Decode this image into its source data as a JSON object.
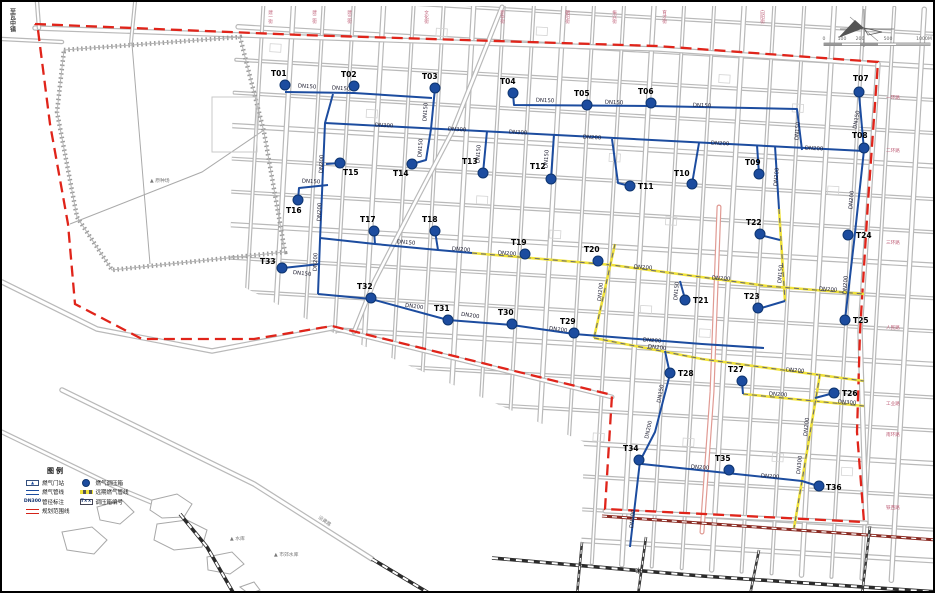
{
  "corner_text": "至瓦中镇",
  "compass": "compass-rose-icon",
  "scale_bar": {
    "labels": [
      "0",
      "100",
      "200",
      "500",
      "1000M"
    ]
  },
  "legend": {
    "title": "图例",
    "items_left": [
      {
        "swatch": "station",
        "sym_text": "▲",
        "label": "燃气门站"
      },
      {
        "swatch": "pipe",
        "sym_text": "",
        "label": "燃气管线"
      },
      {
        "swatch": "dn",
        "sym_text": "DN300",
        "label": "管径标注"
      },
      {
        "swatch": "bound",
        "sym_text": "",
        "label": "规划范围线"
      }
    ],
    "items_right": [
      {
        "swatch": "dot",
        "sym_text": "",
        "label": "燃气调压箱"
      },
      {
        "swatch": "future",
        "sym_text": "",
        "label": "远期燃气管线"
      },
      {
        "swatch": "tnum",
        "sym_text": "T××",
        "label": "调压箱编号"
      }
    ]
  },
  "colors": {
    "pipe_blue": "#1c4c9f",
    "pipe_yellow": "#f0e23a",
    "boundary_red": "#e0241a",
    "road_gray": "#b9b9b9",
    "rail_black": "#2b2b2b",
    "road_red_edge": "#e09a93"
  },
  "markers": [
    {
      "id": "T01",
      "x": 283,
      "y": 83,
      "lx": 269,
      "ly": 74
    },
    {
      "id": "T02",
      "x": 352,
      "y": 84,
      "lx": 339,
      "ly": 75
    },
    {
      "id": "T03",
      "x": 433,
      "y": 86,
      "lx": 420,
      "ly": 77
    },
    {
      "id": "T04",
      "x": 511,
      "y": 91,
      "lx": 498,
      "ly": 82
    },
    {
      "id": "T05",
      "x": 585,
      "y": 103,
      "lx": 572,
      "ly": 94
    },
    {
      "id": "T06",
      "x": 649,
      "y": 101,
      "lx": 636,
      "ly": 92
    },
    {
      "id": "T07",
      "x": 857,
      "y": 90,
      "lx": 851,
      "ly": 79
    },
    {
      "id": "T08",
      "x": 862,
      "y": 146,
      "lx": 850,
      "ly": 136
    },
    {
      "id": "T09",
      "x": 757,
      "y": 172,
      "lx": 743,
      "ly": 163
    },
    {
      "id": "T10",
      "x": 690,
      "y": 182,
      "lx": 672,
      "ly": 174
    },
    {
      "id": "T11",
      "x": 628,
      "y": 184,
      "lx": 636,
      "ly": 187
    },
    {
      "id": "T12",
      "x": 549,
      "y": 177,
      "lx": 528,
      "ly": 167
    },
    {
      "id": "T13",
      "x": 481,
      "y": 171,
      "lx": 460,
      "ly": 162
    },
    {
      "id": "T14",
      "x": 410,
      "y": 162,
      "lx": 391,
      "ly": 174
    },
    {
      "id": "T15",
      "x": 338,
      "y": 161,
      "lx": 341,
      "ly": 173
    },
    {
      "id": "T16",
      "x": 296,
      "y": 198,
      "lx": 284,
      "ly": 211
    },
    {
      "id": "T17",
      "x": 372,
      "y": 229,
      "lx": 358,
      "ly": 220
    },
    {
      "id": "T18",
      "x": 433,
      "y": 229,
      "lx": 420,
      "ly": 220
    },
    {
      "id": "T19",
      "x": 523,
      "y": 252,
      "lx": 509,
      "ly": 243
    },
    {
      "id": "T20",
      "x": 596,
      "y": 259,
      "lx": 582,
      "ly": 250
    },
    {
      "id": "T21",
      "x": 683,
      "y": 298,
      "lx": 691,
      "ly": 301
    },
    {
      "id": "T22",
      "x": 758,
      "y": 232,
      "lx": 744,
      "ly": 223
    },
    {
      "id": "T23",
      "x": 756,
      "y": 306,
      "lx": 742,
      "ly": 297
    },
    {
      "id": "T24",
      "x": 846,
      "y": 233,
      "lx": 854,
      "ly": 236
    },
    {
      "id": "T25",
      "x": 843,
      "y": 318,
      "lx": 851,
      "ly": 321
    },
    {
      "id": "T26",
      "x": 832,
      "y": 391,
      "lx": 840,
      "ly": 394
    },
    {
      "id": "T27",
      "x": 740,
      "y": 379,
      "lx": 726,
      "ly": 370
    },
    {
      "id": "T28",
      "x": 668,
      "y": 371,
      "lx": 676,
      "ly": 374
    },
    {
      "id": "T29",
      "x": 572,
      "y": 331,
      "lx": 558,
      "ly": 322
    },
    {
      "id": "T30",
      "x": 510,
      "y": 322,
      "lx": 496,
      "ly": 313
    },
    {
      "id": "T31",
      "x": 446,
      "y": 318,
      "lx": 432,
      "ly": 309
    },
    {
      "id": "T32",
      "x": 369,
      "y": 296,
      "lx": 355,
      "ly": 287
    },
    {
      "id": "T33",
      "x": 280,
      "y": 266,
      "lx": 258,
      "ly": 262
    },
    {
      "id": "T34",
      "x": 637,
      "y": 458,
      "lx": 621,
      "ly": 449
    },
    {
      "id": "T35",
      "x": 727,
      "y": 468,
      "lx": 713,
      "ly": 459
    },
    {
      "id": "T36",
      "x": 817,
      "y": 484,
      "lx": 824,
      "ly": 488
    }
  ],
  "pipelines": {
    "blue": [
      [
        [
          283,
          90
        ],
        [
          352,
          91
        ],
        [
          430,
          96
        ]
      ],
      [
        [
          433,
          86
        ],
        [
          429,
          127
        ]
      ],
      [
        [
          429,
          127
        ],
        [
          424,
          158
        ],
        [
          410,
          162
        ]
      ],
      [
        [
          323,
          121
        ],
        [
          862,
          149
        ]
      ],
      [
        [
          331,
          92
        ],
        [
          323,
          121
        ],
        [
          318,
          238
        ],
        [
          316,
          292
        ]
      ],
      [
        [
          316,
          292
        ],
        [
          369,
          297
        ],
        [
          446,
          318
        ],
        [
          510,
          323
        ],
        [
          572,
          332
        ],
        [
          700,
          342
        ],
        [
          762,
          346
        ]
      ],
      [
        [
          318,
          262
        ],
        [
          281,
          266
        ]
      ],
      [
        [
          326,
          183
        ],
        [
          297,
          186
        ],
        [
          296,
          198
        ]
      ],
      [
        [
          324,
          162
        ],
        [
          338,
          161
        ]
      ],
      [
        [
          485,
          129
        ],
        [
          481,
          171
        ]
      ],
      [
        [
          552,
          132
        ],
        [
          549,
          177
        ]
      ],
      [
        [
          511,
          92
        ],
        [
          512,
          103
        ],
        [
          648,
          104
        ],
        [
          795,
          107
        ],
        [
          800,
          148
        ]
      ],
      [
        [
          857,
          92
        ],
        [
          862,
          148
        ],
        [
          852,
          240
        ],
        [
          843,
          318
        ]
      ],
      [
        [
          755,
          143
        ],
        [
          757,
          172
        ]
      ],
      [
        [
          697,
          141
        ],
        [
          690,
          182
        ]
      ],
      [
        [
          610,
          137
        ],
        [
          616,
          181
        ],
        [
          628,
          184
        ]
      ],
      [
        [
          318,
          236
        ],
        [
          373,
          242
        ],
        [
          436,
          248
        ],
        [
          470,
          251
        ]
      ],
      [
        [
          372,
          229
        ],
        [
          373,
          242
        ]
      ],
      [
        [
          433,
          229
        ],
        [
          436,
          248
        ]
      ],
      [
        [
          678,
          279
        ],
        [
          683,
          297
        ]
      ],
      [
        [
          773,
          144
        ],
        [
          777,
          207
        ]
      ],
      [
        [
          758,
          233
        ],
        [
          778,
          238
        ]
      ],
      [
        [
          756,
          307
        ],
        [
          783,
          299
        ]
      ],
      [
        [
          740,
          380
        ],
        [
          741,
          392
        ]
      ],
      [
        [
          832,
          391
        ],
        [
          813,
          396
        ]
      ],
      [
        [
          663,
          349
        ],
        [
          668,
          372
        ],
        [
          653,
          430
        ],
        [
          638,
          459
        ],
        [
          628,
          545
        ]
      ],
      [
        [
          640,
          462
        ],
        [
          800,
          479
        ],
        [
          816,
          484
        ]
      ]
    ],
    "yellow": [
      [
        [
          470,
          251
        ],
        [
          610,
          263
        ],
        [
          765,
          284
        ],
        [
          862,
          292
        ]
      ],
      [
        [
          613,
          242
        ],
        [
          592,
          336
        ]
      ],
      [
        [
          592,
          336
        ],
        [
          700,
          357
        ],
        [
          862,
          379
        ]
      ],
      [
        [
          741,
          392
        ],
        [
          862,
          404
        ]
      ],
      [
        [
          818,
          372
        ],
        [
          800,
          479
        ],
        [
          792,
          526
        ]
      ],
      [
        [
          777,
          207
        ],
        [
          783,
          299
        ]
      ]
    ]
  },
  "boundary": [
    [
      33,
      22
    ],
    [
      300,
      33
    ],
    [
      655,
      44
    ],
    [
      876,
      60
    ],
    [
      866,
      200
    ],
    [
      858,
      330
    ],
    [
      855,
      430
    ],
    [
      862,
      520
    ],
    [
      603,
      507
    ],
    [
      610,
      393
    ],
    [
      330,
      324
    ],
    [
      252,
      337
    ],
    [
      140,
      337
    ],
    [
      73,
      302
    ],
    [
      66,
      222
    ],
    [
      48,
      122
    ],
    [
      36,
      28
    ],
    [
      33,
      22
    ]
  ],
  "pipe_labels": [
    {
      "t": "DN150",
      "x": 305,
      "y": 86,
      "r": 4
    },
    {
      "t": "DN150",
      "x": 339,
      "y": 88,
      "r": 4
    },
    {
      "t": "DN150",
      "x": 425,
      "y": 110,
      "r": -86
    },
    {
      "t": "DN150",
      "x": 420,
      "y": 146,
      "r": -86
    },
    {
      "t": "DN300",
      "x": 382,
      "y": 125,
      "r": 3
    },
    {
      "t": "DN300",
      "x": 455,
      "y": 129,
      "r": 3
    },
    {
      "t": "DN300",
      "x": 516,
      "y": 132,
      "r": 3
    },
    {
      "t": "DN200",
      "x": 590,
      "y": 137,
      "r": 3
    },
    {
      "t": "DN200",
      "x": 718,
      "y": 143,
      "r": 3
    },
    {
      "t": "DN200",
      "x": 812,
      "y": 148,
      "r": 3
    },
    {
      "t": "DN200",
      "x": 321,
      "y": 162,
      "r": -88
    },
    {
      "t": "DN200",
      "x": 319,
      "y": 210,
      "r": -88
    },
    {
      "t": "DN200",
      "x": 315,
      "y": 260,
      "r": -88
    },
    {
      "t": "DN200",
      "x": 412,
      "y": 306,
      "r": 7
    },
    {
      "t": "DN200",
      "x": 468,
      "y": 315,
      "r": 8
    },
    {
      "t": "DN200",
      "x": 556,
      "y": 329,
      "r": 7
    },
    {
      "t": "DN200",
      "x": 650,
      "y": 340,
      "r": 4
    },
    {
      "t": "DN150",
      "x": 300,
      "y": 273,
      "r": 6
    },
    {
      "t": "DN150",
      "x": 309,
      "y": 181,
      "r": 3
    },
    {
      "t": "DN150",
      "x": 478,
      "y": 152,
      "r": -86
    },
    {
      "t": "DN150",
      "x": 546,
      "y": 157,
      "r": -86
    },
    {
      "t": "DN150",
      "x": 543,
      "y": 100,
      "r": 2
    },
    {
      "t": "DN150",
      "x": 612,
      "y": 102,
      "r": 2
    },
    {
      "t": "DN150",
      "x": 700,
      "y": 105,
      "r": 2
    },
    {
      "t": "DN150",
      "x": 797,
      "y": 129,
      "r": -85
    },
    {
      "t": "DN150",
      "x": 856,
      "y": 118,
      "r": -80
    },
    {
      "t": "DN200",
      "x": 851,
      "y": 198,
      "r": -85
    },
    {
      "t": "DN200",
      "x": 845,
      "y": 283,
      "r": -86
    },
    {
      "t": "DN150",
      "x": 404,
      "y": 242,
      "r": 5
    },
    {
      "t": "DN200",
      "x": 459,
      "y": 249,
      "r": 5
    },
    {
      "t": "DN200",
      "x": 776,
      "y": 175,
      "r": -85
    },
    {
      "t": "DN150",
      "x": 780,
      "y": 272,
      "r": -85
    },
    {
      "t": "DN150",
      "x": 676,
      "y": 289,
      "r": -85
    },
    {
      "t": "DN150",
      "x": 660,
      "y": 392,
      "r": -80
    },
    {
      "t": "DN200",
      "x": 648,
      "y": 428,
      "r": -78
    },
    {
      "t": "DN200",
      "x": 698,
      "y": 467,
      "r": 4
    },
    {
      "t": "DN200",
      "x": 768,
      "y": 476,
      "r": 4
    },
    {
      "t": "DN200",
      "x": 632,
      "y": 517,
      "r": -84
    },
    {
      "t": "DN200",
      "x": 505,
      "y": 253,
      "r": 4
    },
    {
      "t": "DN200",
      "x": 641,
      "y": 267,
      "r": 4
    },
    {
      "t": "DN200",
      "x": 719,
      "y": 278,
      "r": 4
    },
    {
      "t": "DN200",
      "x": 826,
      "y": 289,
      "r": 4
    },
    {
      "t": "DN200",
      "x": 600,
      "y": 290,
      "r": -84
    },
    {
      "t": "DN200",
      "x": 655,
      "y": 347,
      "r": 6
    },
    {
      "t": "DN200",
      "x": 793,
      "y": 370,
      "r": 5
    },
    {
      "t": "DN200",
      "x": 776,
      "y": 394,
      "r": 4
    },
    {
      "t": "DN300",
      "x": 845,
      "y": 402,
      "r": 4
    },
    {
      "t": "DN200",
      "x": 806,
      "y": 425,
      "r": -84
    },
    {
      "t": "DN300",
      "x": 799,
      "y": 463,
      "r": -84
    }
  ],
  "street_labels_top": [
    {
      "t": "建一街",
      "x": 268
    },
    {
      "t": "建二街",
      "x": 312
    },
    {
      "t": "建三街",
      "x": 347
    },
    {
      "t": "文化街",
      "x": 424
    },
    {
      "t": "新华街",
      "x": 500
    },
    {
      "t": "朝阳街",
      "x": 565
    },
    {
      "t": "振兴街",
      "x": 612
    },
    {
      "t": "育才街",
      "x": 662
    },
    {
      "t": "向阳街",
      "x": 760
    }
  ],
  "street_labels_right": [
    {
      "t": "一环路",
      "x": 884,
      "y": 97
    },
    {
      "t": "二环路",
      "x": 884,
      "y": 150
    },
    {
      "t": "三环路",
      "x": 884,
      "y": 242
    },
    {
      "t": "人民路",
      "x": 884,
      "y": 327
    },
    {
      "t": "工业路",
      "x": 884,
      "y": 403
    },
    {
      "t": "南环路",
      "x": 884,
      "y": 434
    },
    {
      "t": "铁西路",
      "x": 884,
      "y": 507
    }
  ],
  "place_labels": [
    {
      "t": "▲ 原种场",
      "x": 148,
      "y": 180
    },
    {
      "t": "▲ 水库",
      "x": 228,
      "y": 538
    },
    {
      "t": "▲ 市郊水库",
      "x": 272,
      "y": 554
    },
    {
      "t": "沿黄路",
      "x": 316,
      "y": 516,
      "r": 36
    },
    {
      "t": "✳",
      "x": 633,
      "y": 572,
      "size": 9
    }
  ]
}
